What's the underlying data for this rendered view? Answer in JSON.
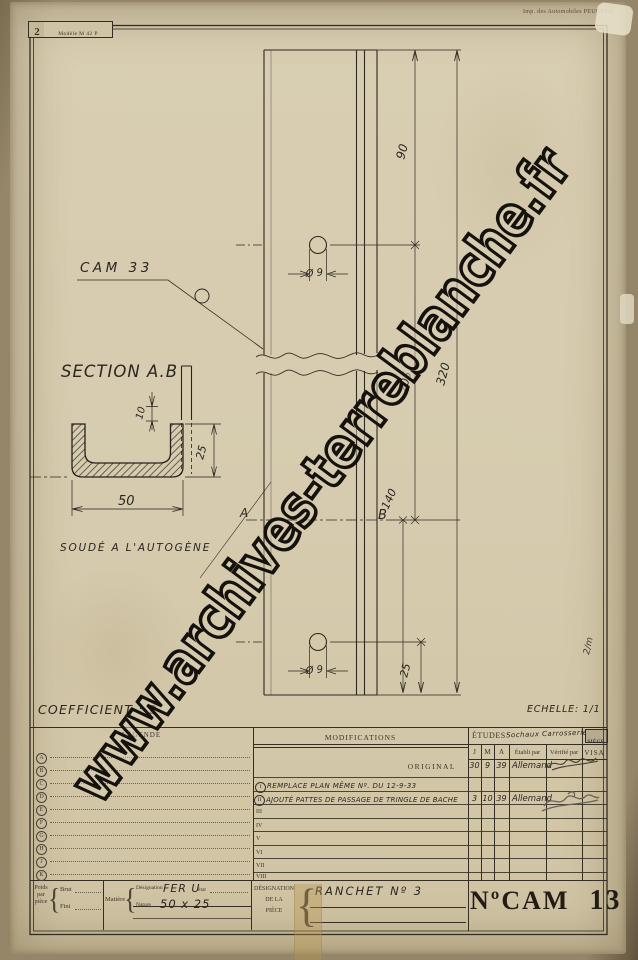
{
  "stamp": {
    "sheet_number": "2",
    "model_label": "Modèle M 42 P"
  },
  "printer_credit": "Imp. des Automobiles PEUGEOT.",
  "watermark": {
    "text": "www.archives-terreblanche.fr"
  },
  "drawing": {
    "part_label": "CAM 33",
    "section_title": "SECTION A.B",
    "weld_note": "SOUDÉ A L'AUTOGÈNE",
    "coefficient_note": "COEFFICIENT : 2",
    "scale_note": "ECHELLE: 1/1",
    "section_mark_a": "A",
    "section_mark_b": "B",
    "pencil_note": "2/m",
    "dims": {
      "overall": "320",
      "top_to_hole": "90",
      "hole_to_section": "205",
      "section_to_end": "140",
      "hole_to_end": "25",
      "hole_top": "Ø 9",
      "hole_bottom": "Ø 9",
      "tab_offset": "10",
      "section_height": "25",
      "section_width": "50"
    }
  },
  "table": {
    "legend_header": "LÉGENDE",
    "modifications_header": "MODIFICATIONS",
    "etudes_header": "ÉTUDES",
    "etudes_note": "Sochaux Carrosserie",
    "siege_header": "SIÈGE",
    "col_j": "J",
    "col_m": "M",
    "col_a": "A",
    "col_etabli": "Établi par",
    "col_verifie": "Vérifié par",
    "col_visa": "VISA",
    "legend_letters": [
      "A",
      "B",
      "C",
      "D",
      "E",
      "F",
      "G",
      "H",
      "J",
      "K"
    ],
    "numerals": [
      "I",
      "II",
      "III",
      "IV",
      "V",
      "VI",
      "VII",
      "VIII"
    ],
    "original_label": "ORIGINAL",
    "rows": {
      "original": {
        "day": "30",
        "month": "9",
        "year": "39",
        "etabli": "Allemand"
      },
      "modif1": {
        "numeral": "I",
        "text": "REMPLACE PLAN MÊME Nº. DU 12-9-33"
      },
      "modif2": {
        "numeral": "II",
        "text": "AJOUTÉ PATTES DE PASSAGE DE TRINGLE DE BACHE",
        "day": "3",
        "month": "10",
        "year": "39",
        "etabli": "Allemand"
      }
    }
  },
  "titleblock": {
    "poids_label": "Poids par pièce",
    "brut_label": "Brut",
    "fini_label": "Fini",
    "matiere_label": "Matière",
    "designation_label": "Désignation",
    "nature_label": "Nature",
    "etat_label": "état",
    "material_value": "FER U",
    "material_size": "50 x 25",
    "piece_label_1": "DÉSIGNATION",
    "piece_label_2": "DE LA",
    "piece_label_3": "PIÈCE",
    "piece_name": "RANCHET Nº 3",
    "plan_label": "NºCAM",
    "plan_number": "13"
  }
}
